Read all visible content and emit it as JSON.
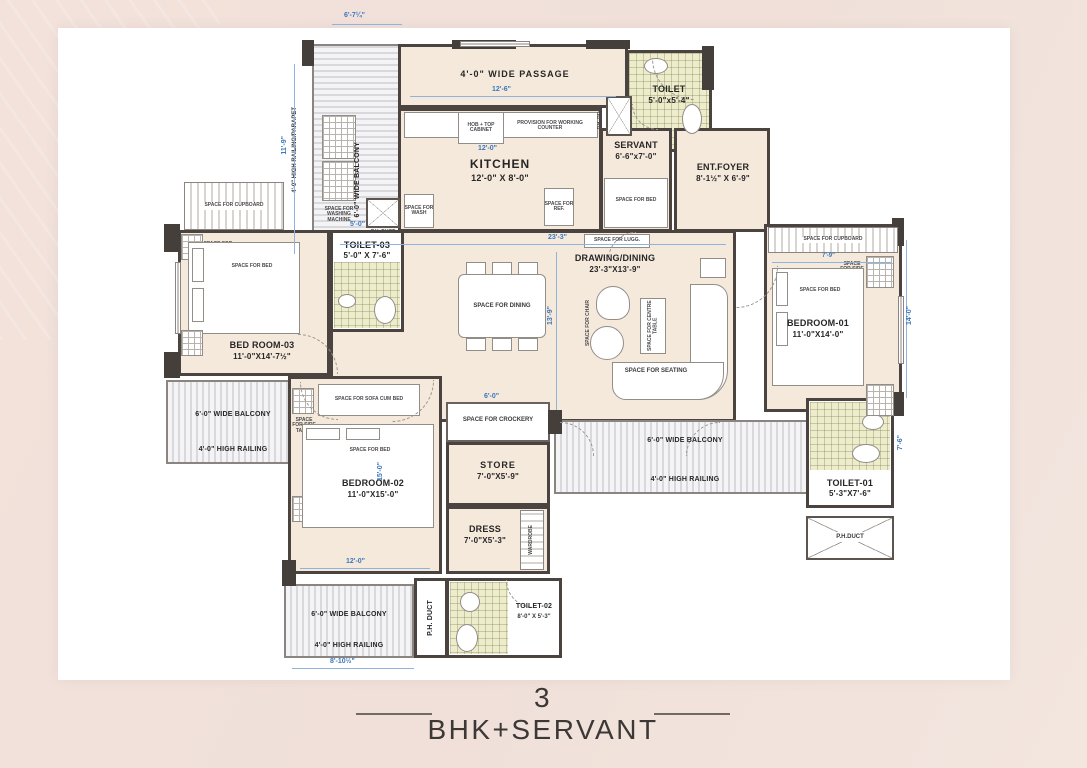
{
  "title": "3 BHK+SERVANT",
  "colors": {
    "page_bg": "#f0e1da",
    "sheet": "#ffffff",
    "wall": "#4a4340",
    "floor": "#f5e9dc",
    "toilet_tile": "#edeccb",
    "dimension_blue": "#3a77bd"
  },
  "rooms": {
    "passage": {
      "name": "4'-0\" WIDE PASSAGE"
    },
    "toilet_top": {
      "name": "TOILET",
      "size": "5'-0\"x5'-4\""
    },
    "kitchen": {
      "name": "KITCHEN",
      "size": "12'-0\" X 8'-0\""
    },
    "servant": {
      "name": "SERVANT",
      "size": "6'-6\"x7'-0\""
    },
    "ent_foyer": {
      "name": "ENT.FOYER",
      "size": "8'-1½\" X 6'-9\""
    },
    "drawing_dining": {
      "name": "DRAWING/DINING",
      "size": "23'-3\"X13'-9\""
    },
    "bedroom_03": {
      "name": "BED ROOM-03",
      "size": "11'-0\"X14'-7½\""
    },
    "toilet_03": {
      "name": "TOILET-03",
      "size": "5'-0\" X 7'-6\""
    },
    "bedroom_02": {
      "name": "BEDROOM-02",
      "size": "11'-0\"X15'-0\""
    },
    "bedroom_01": {
      "name": "BEDROOM-01",
      "size": "11'-0\"X14'-0\""
    },
    "store": {
      "name": "STORE",
      "size": "7'-0\"X5'-9\""
    },
    "dress": {
      "name": "DRESS",
      "size": "7'-0\"X5'-3\""
    },
    "toilet_01": {
      "name": "TOILET-01",
      "size": "5'-3\"X7'-6\""
    },
    "toilet_02": {
      "name": "TOILET-02",
      "size": "8'-0\" X 5'-3\""
    }
  },
  "balcony": {
    "wide": "6'-0\" WIDE BALCONY",
    "railing": "4'-0\" HIGH RAILING",
    "railing_parapet": "4'-0\" HIGH RAILING/PARAPET"
  },
  "annotations": {
    "ph_duct": "P.H. DUCT",
    "ph_duct_compact": "P.H.DUCT",
    "space_cupboard": "SPACE FOR CUPBOARD",
    "space_bed": "SPACE FOR BED",
    "space_side_table": "SPACE FOR SIDE TABLE",
    "space_dining": "SPACE FOR DINING",
    "space_centre_table": "SPACE FOR CENTRE TABLE",
    "space_seating": "SPACE FOR SEATING",
    "space_chair": "SPACE FOR CHAIR",
    "space_crockery": "SPACE FOR CROCKERY",
    "space_sofa_cum_bed": "SPACE FOR SOFA CUM BED",
    "space_luggage": "SPACE FOR LUGG.",
    "space_washing_machine": "SPACE FOR WASHING MACHINE",
    "provision_counter": "PROVISION FOR WORKING COUNTER",
    "hob_cabinet": "HOB + TOP CABINET",
    "space_ref": "SPACE FOR REF.",
    "space_wash": "SPACE FOR WASH",
    "wardrobe": "WARDROBE"
  },
  "dimensions": {
    "top_left_width": "6'-7¼\"",
    "left_height": "11'-9\"",
    "passage_width": "12'-6\"",
    "kitchen_width": "12'-0\"",
    "drawing_width": "23'-3\"",
    "drawing_height": "13'-9\"",
    "toilet03_width": "5'-0\"",
    "cupboard_width": "7'-9\"",
    "toilet01_height": "7'-6\"",
    "bedroom01_height": "14'-0\"",
    "bedroom02_height": "15'-0\"",
    "bedroom02_width": "12'-0\"",
    "bottom_balcony_width": "8'-10½\"",
    "crockery_width": "6'-0\""
  }
}
